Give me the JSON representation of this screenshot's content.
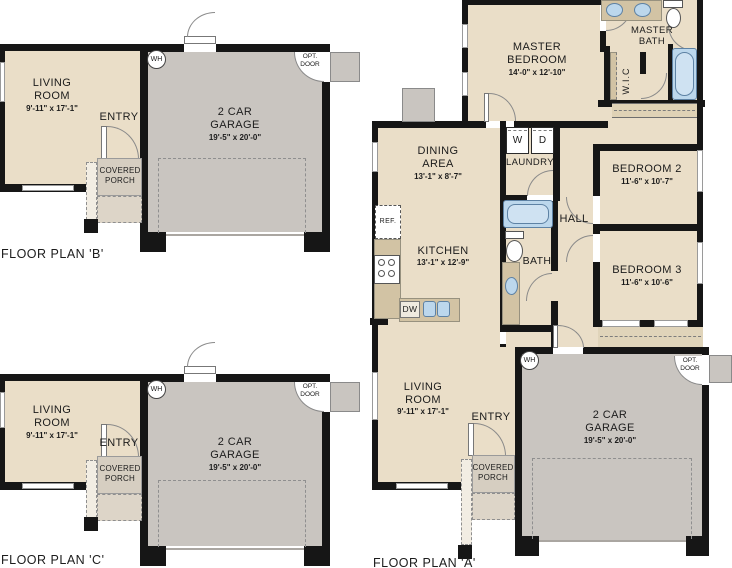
{
  "plan_b": {
    "title": "FLOOR PLAN 'B'",
    "living_room": {
      "l1": "LIVING",
      "l2": "ROOM",
      "dims": "9'-11\" x 17'-1\""
    },
    "entry": "ENTRY",
    "covered_porch": {
      "l1": "COVERED",
      "l2": "PORCH"
    },
    "water_heater": "WH",
    "garage": {
      "l1": "2 CAR",
      "l2": "GARAGE",
      "dims": "19'-5\" x 20'-0\""
    },
    "opt_door": {
      "l1": "OPT.",
      "l2": "DOOR"
    }
  },
  "plan_c": {
    "title": "FLOOR PLAN 'C'",
    "living_room": {
      "l1": "LIVING",
      "l2": "ROOM",
      "dims": "9'-11\" x 17'-1\""
    },
    "entry": "ENTRY",
    "covered_porch": {
      "l1": "COVERED",
      "l2": "PORCH"
    },
    "water_heater": "WH",
    "garage": {
      "l1": "2 CAR",
      "l2": "GARAGE",
      "dims": "19'-5\" x 20'-0\""
    },
    "opt_door": {
      "l1": "OPT.",
      "l2": "DOOR"
    }
  },
  "plan_a": {
    "title": "FLOOR PLAN 'A'",
    "master_bedroom": {
      "l1": "MASTER",
      "l2": "BEDROOM",
      "dims": "14'-0\" x 12'-10\""
    },
    "master_bath": {
      "l1": "MASTER",
      "l2": "BATH"
    },
    "wic": "W.I.C",
    "dining_area": {
      "l1": "DINING",
      "l2": "AREA",
      "dims": "13'-1\" x 8'-7\""
    },
    "laundry": {
      "label": "LAUNDRY",
      "washer": "W",
      "dryer": "D"
    },
    "bedroom_2": {
      "name": "BEDROOM 2",
      "dims": "11'-6\" x 10'-7\""
    },
    "bedroom_3": {
      "name": "BEDROOM 3",
      "dims": "11'-6\" x 10'-6\""
    },
    "hall": "HALL",
    "bath": "BATH",
    "kitchen": {
      "name": "KITCHEN",
      "dims": "13'-1\" x 12'-9\"",
      "ref": "REF.",
      "dw": "DW"
    },
    "living_room": {
      "l1": "LIVING",
      "l2": "ROOM",
      "dims": "9'-11\" x 17'-1\""
    },
    "entry": "ENTRY",
    "covered_porch": {
      "l1": "COVERED",
      "l2": "PORCH"
    },
    "water_heater": "WH",
    "garage": {
      "l1": "2 CAR",
      "l2": "GARAGE",
      "dims": "19'-5\" x 20'-0\""
    },
    "opt_door": {
      "l1": "OPT.",
      "l2": "DOOR"
    }
  },
  "colors": {
    "room_fill": "#EADEC8",
    "garage_fill": "#C9C5C0",
    "porch_fill": "#D6CEC1",
    "counter_fill": "#D2C3A4",
    "fixture_blue": "#BCD7EC",
    "wall": "#161616"
  }
}
